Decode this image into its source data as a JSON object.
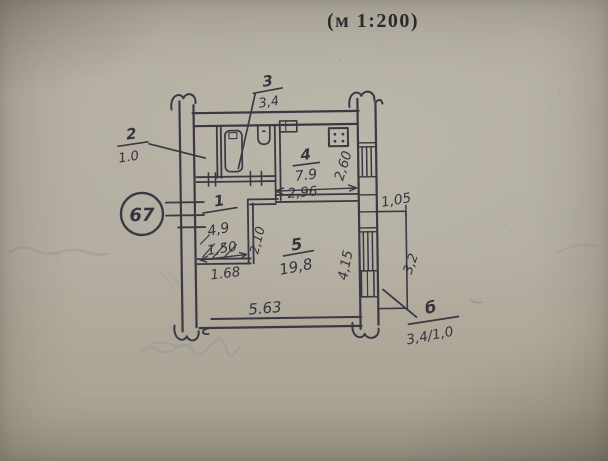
{
  "document": {
    "scale_note": "(м 1:200)",
    "apartment_number": "67"
  },
  "rooms": [
    {
      "number": "1",
      "area": "4,9"
    },
    {
      "number": "2",
      "area": "1.0"
    },
    {
      "number": "3",
      "area": "3,4"
    },
    {
      "number": "4",
      "area": "7.9"
    },
    {
      "number": "5",
      "area": "19,8"
    },
    {
      "number": "б",
      "area": "3,4/1,0"
    }
  ],
  "dimensions": {
    "closet_inner_width": "1,50",
    "closet_outer_width": "1.68",
    "hall_opening": "2,10",
    "kitchen_width": "2,96",
    "kitchen_depth": "2,60",
    "living_width": "5.63",
    "living_depth": "4,15",
    "balcony_width": "1,05",
    "balcony_length": "3,2"
  },
  "colors": {
    "ink": "#3b3843",
    "paper": "#b3aea1",
    "bleed_ink": "#8e8ca2"
  }
}
